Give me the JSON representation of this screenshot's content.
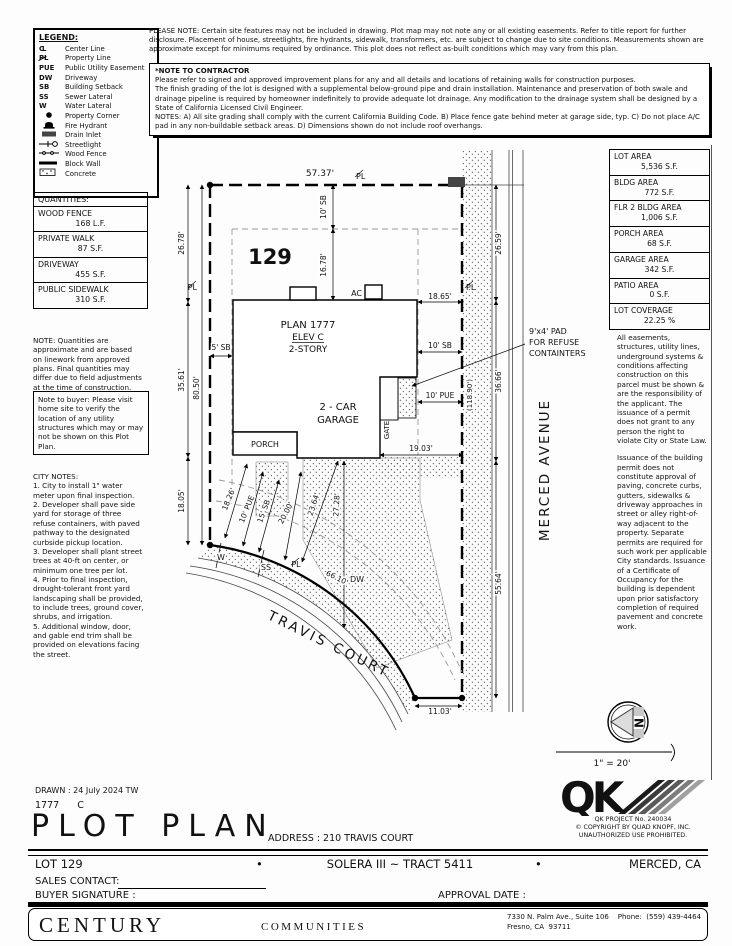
{
  "header": {
    "please_note": "PLEASE NOTE:  Certain site features may not be included in drawing.  Plot map may not note any or all existing easements. Refer to title report for further disclosure.  Placement of house, streetlights, fire hydrants, sidewalk, transformers, etc. are subject to change due to site conditions.  Measurements shown are approximate except for minimums required by ordinance.  This plot does not reflect as-built conditions which may vary from this plan.",
    "contractor_title": "*NOTE TO CONTRACTOR",
    "contractor_p1": "Please refer to signed and approved improvement plans for any and all details and locations of retaining walls for construction purposes.",
    "contractor_p2": "The finish grading of the lot is designed with a supplemental below-ground pipe and drain installation.  Maintenance and preservation of both swale and drainage pipeline is required by homeowner indefinitely to provide adequate lot drainage.  Any modification to the drainage system shall be designed by a State of California Licensed Civil Engineer.",
    "contractor_p3": "NOTES:  A) All site grading shall comply with the current California Building Code.  B) Place fence gate behind meter at garage side, typ.  C) Do not place A/C pad in any non-buildable setback areas.  D) Dimensions shown do not include roof overhangs."
  },
  "legend": {
    "title": "LEGEND:",
    "items": [
      {
        "sym": "CL",
        "label": "Center Line"
      },
      {
        "sym": "PL",
        "label": "Property Line"
      },
      {
        "sym": "PUE",
        "label": "Public Utility Easement"
      },
      {
        "sym": "DW",
        "label": "Driveway"
      },
      {
        "sym": "SB",
        "label": "Building Setback"
      },
      {
        "sym": "SS",
        "label": "Sewer Lateral"
      },
      {
        "sym": "W",
        "label": "Water Lateral"
      },
      {
        "sym": "",
        "label": "Property Corner"
      },
      {
        "sym": "",
        "label": "Fire Hydrant"
      },
      {
        "sym": "",
        "label": "Drain Inlet"
      },
      {
        "sym": "",
        "label": "Streetlight"
      },
      {
        "sym": "",
        "label": "Wood Fence"
      },
      {
        "sym": "",
        "label": "Block Wall"
      },
      {
        "sym": "",
        "label": "Concrete"
      }
    ]
  },
  "quantities": {
    "title": "QUANTITIES:",
    "items": [
      {
        "name": "WOOD FENCE",
        "value": "168 L.F."
      },
      {
        "name": "PRIVATE WALK",
        "value": "87 S.F."
      },
      {
        "name": "DRIVEWAY",
        "value": "455 S.F."
      },
      {
        "name": "PUBLIC SIDEWALK",
        "value": "310 S.F."
      }
    ],
    "note": "NOTE: Quantities are approximate and are based on linework from approved plans.  Final quantities may differ due to field adjustments at the time of construction."
  },
  "buyer_note": "Note to buyer: Please visit home site to verify the location of any utility structures which may or may not be shown on this Plot Plan.",
  "city_notes": {
    "title": "CITY NOTES:",
    "items": [
      "1. City to install 1\" water meter upon final inspection.",
      "2. Developer shall pave side yard for storage of three refuse containers, with paved pathway to the designated curbside pickup location.",
      "3. Developer shall plant street trees at 40-ft on center, or minimum one tree per lot.",
      "4. Prior to final inspection, drought-tolerant front yard landscaping shall be provided, to include trees, ground cover, shrubs, and irrigation.",
      "5. Additional window, door, and gable end trim shall be provided on elevations facing the street."
    ]
  },
  "areas": {
    "items": [
      {
        "name": "LOT AREA",
        "value": "5,536 S.F."
      },
      {
        "name": "BLDG AREA",
        "value": "772 S.F."
      },
      {
        "name": "FLR 2 BLDG AREA",
        "value": "1,006 S.F."
      },
      {
        "name": "PORCH AREA",
        "value": "68 S.F."
      },
      {
        "name": "GARAGE AREA",
        "value": "342 S.F."
      },
      {
        "name": "PATIO AREA",
        "value": "0 S.F."
      },
      {
        "name": "LOT COVERAGE",
        "value": "22.25 %"
      }
    ]
  },
  "right_notes": {
    "p1": "All easements, structures, utility lines, underground systems & conditions affecting construction on this parcel must be shown & are the responsibility of the applicant. The issuance of a permit does not grant to any person the right to violate City or State Law.",
    "p2": "Issuance of the building permit does not constitute approval of paving, concrete curbs, gutters, sidewalks & driveway approaches in street or alley right-of-way adjacent to the property. Separate permits are required for such work per applicable City standards. Issuance of a Certificate of Occupancy for the building is dependent upon prior satisfactory completion of required pavement and concrete work."
  },
  "plot": {
    "house": {
      "lot_no": "129",
      "plan": "PLAN 1777",
      "elev": "ELEV C",
      "story": "2-STORY",
      "garage1": "2 - CAR",
      "garage2": "GARAGE",
      "porch": "PORCH",
      "gate": "GATE"
    },
    "labels": {
      "pl": "PL",
      "w": "W",
      "ss": "SS",
      "dw": "DW",
      "ac": "AC"
    },
    "streets": {
      "travis": "TRAVIS COURT",
      "merced": "MERCED AVENUE"
    },
    "callout": {
      "l1": "9'x4' PAD",
      "l2": "FOR REFUSE",
      "l3": "CONTAINTERS"
    },
    "dims": {
      "top5737": "57.37'",
      "left2678": "26.78'",
      "left3561": "35.61'",
      "left1805": "18.05'",
      "left8050": "80.50'",
      "sb5": "5' SB",
      "sb10t": "10' SB",
      "d1678": "16.78'",
      "d1865": "18.65'",
      "sb10r": "10' SB",
      "pue10r": "10' PUE",
      "d1903": "19.03'",
      "d1826": "18.26'",
      "pue10f": "10' PUE",
      "sb15": "15' SB",
      "d2000": "20.00'",
      "d2364": "23.64'",
      "d2728": "27.28'",
      "d6610": "66.10'",
      "d1103": "11.03'",
      "d5564": "55.64'",
      "d2659": "26.59'",
      "d3666": "36.66'",
      "total11890": "(118.90')"
    },
    "compass_n": "N",
    "scale": "1\" = 20'"
  },
  "title_block": {
    "drawn": "DRAWN :  24 July 2024   TW",
    "plan_code": "1777      C",
    "title": "PLOT PLAN",
    "address": "ADDRESS :   210 TRAVIS COURT",
    "lot": "LOT 129",
    "bullet": "•",
    "tract": "SOLERA III ~ TRACT 5411",
    "city": "MERCED, CA",
    "sales_contact_label": "SALES CONTACT:",
    "buyer_signature_label": "BUYER SIGNATURE :",
    "approval_date_label": "APPROVAL DATE :"
  },
  "qk": {
    "logo": "QK",
    "project": "QK PROJECT No. 240034",
    "copyright": "©   COPYRIGHT BY QUAD KNOPF, INC.",
    "prohibited": "UNAUTHORIZED USE PROHIBITED."
  },
  "footer": {
    "brand": "CENTURY",
    "brand2": "COMMUNITIES",
    "address1": "7330 N. Palm Ave., Suite 106    Phone:  (559) 439-4464",
    "address2": "Fresno, CA  93711"
  }
}
